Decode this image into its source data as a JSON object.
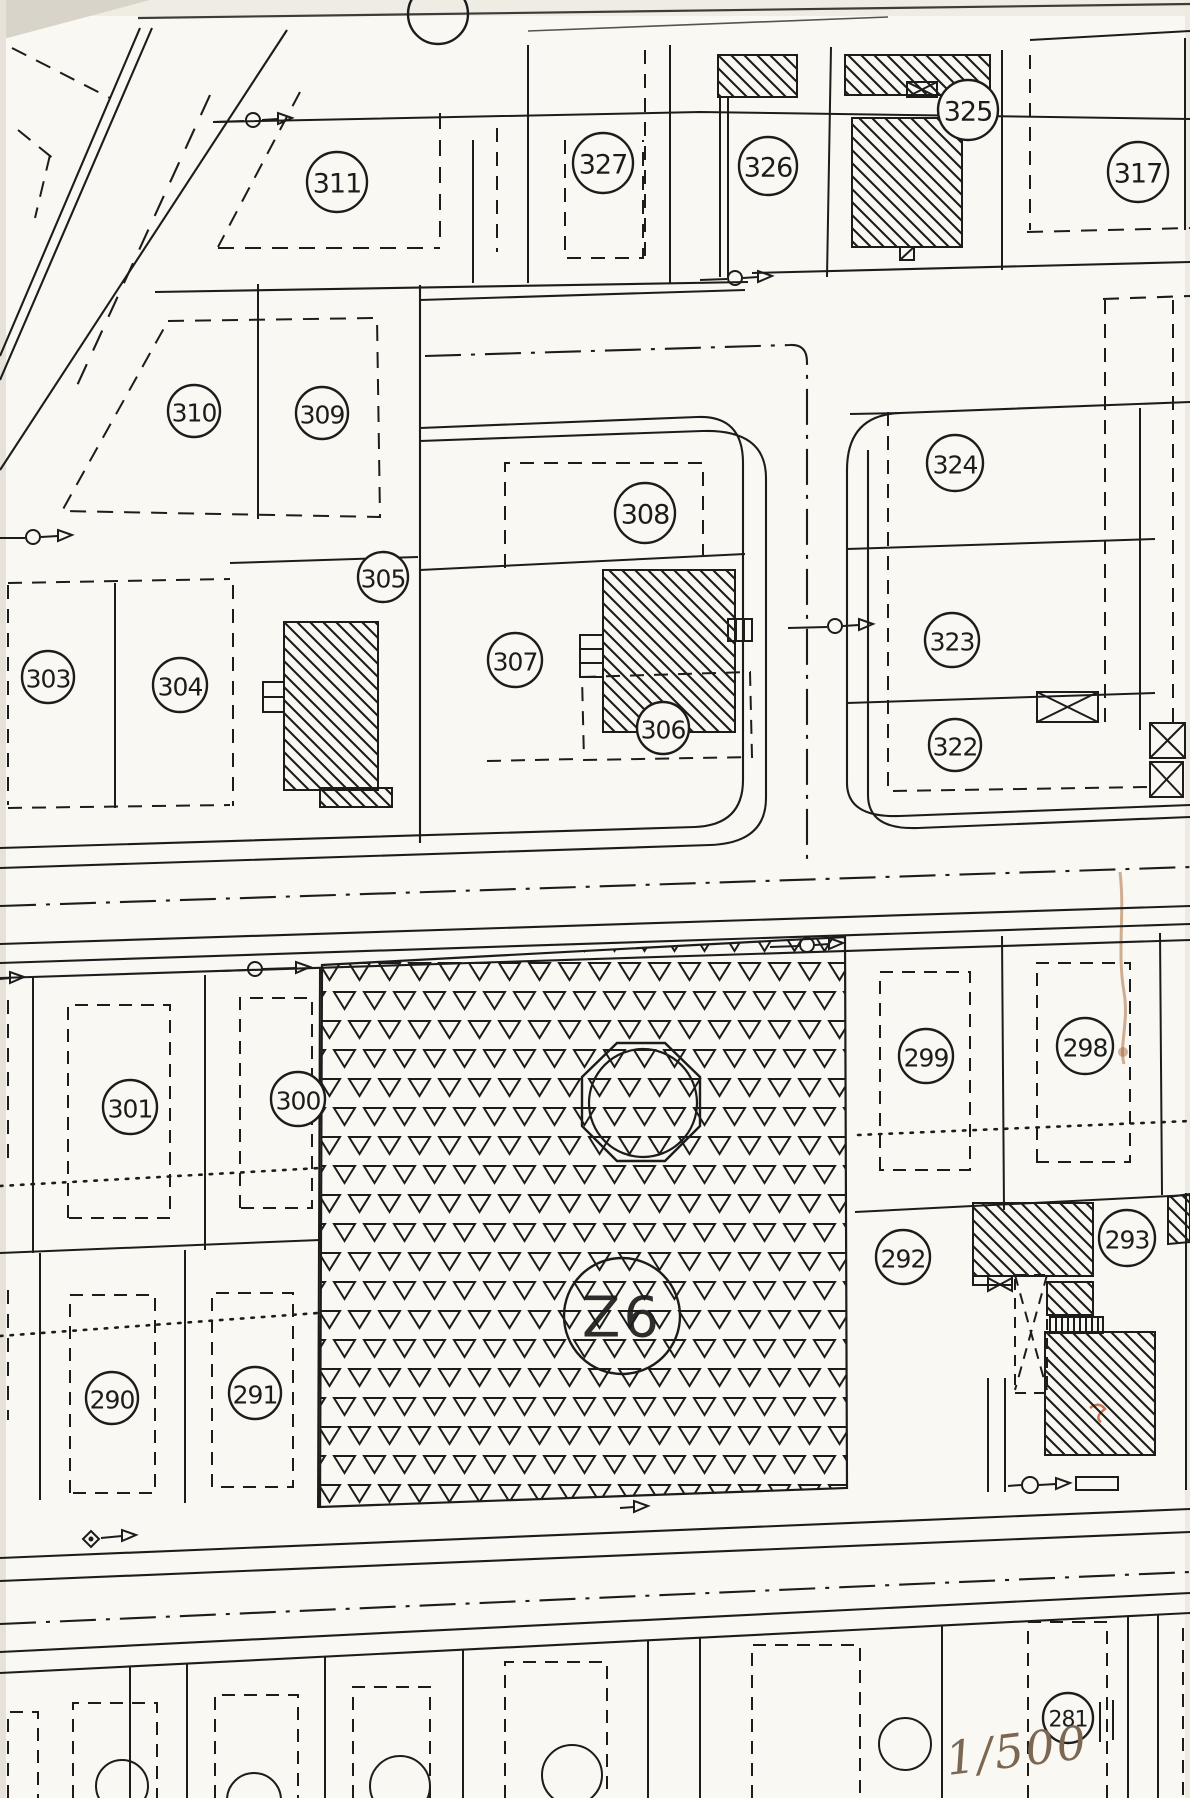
{
  "colors": {
    "ink": "#1c1c1c",
    "paper": "#faf8f2",
    "annotation_ink": "#7b6752",
    "stain": "#a4622f"
  },
  "parcels": {
    "p281": {
      "label": "281"
    },
    "p290": {
      "label": "290"
    },
    "p291": {
      "label": "291"
    },
    "p292": {
      "label": "292"
    },
    "p293": {
      "label": "293"
    },
    "p298": {
      "label": "298"
    },
    "p299": {
      "label": "299"
    },
    "p300": {
      "label": "300"
    },
    "p301": {
      "label": "301"
    },
    "p303": {
      "label": "303"
    },
    "p304": {
      "label": "304"
    },
    "p305": {
      "label": "305"
    },
    "p306": {
      "label": "306"
    },
    "p307": {
      "label": "307"
    },
    "p308": {
      "label": "308"
    },
    "p309": {
      "label": "309"
    },
    "p310": {
      "label": "310"
    },
    "p311": {
      "label": "311"
    },
    "p317": {
      "label": "317"
    },
    "p322": {
      "label": "322"
    },
    "p323": {
      "label": "323"
    },
    "p324": {
      "label": "324"
    },
    "p325": {
      "label": "325"
    },
    "p326": {
      "label": "326"
    },
    "p327": {
      "label": "327"
    }
  },
  "zone": {
    "label": "Z6"
  },
  "scale_note": {
    "text": "1/500"
  }
}
